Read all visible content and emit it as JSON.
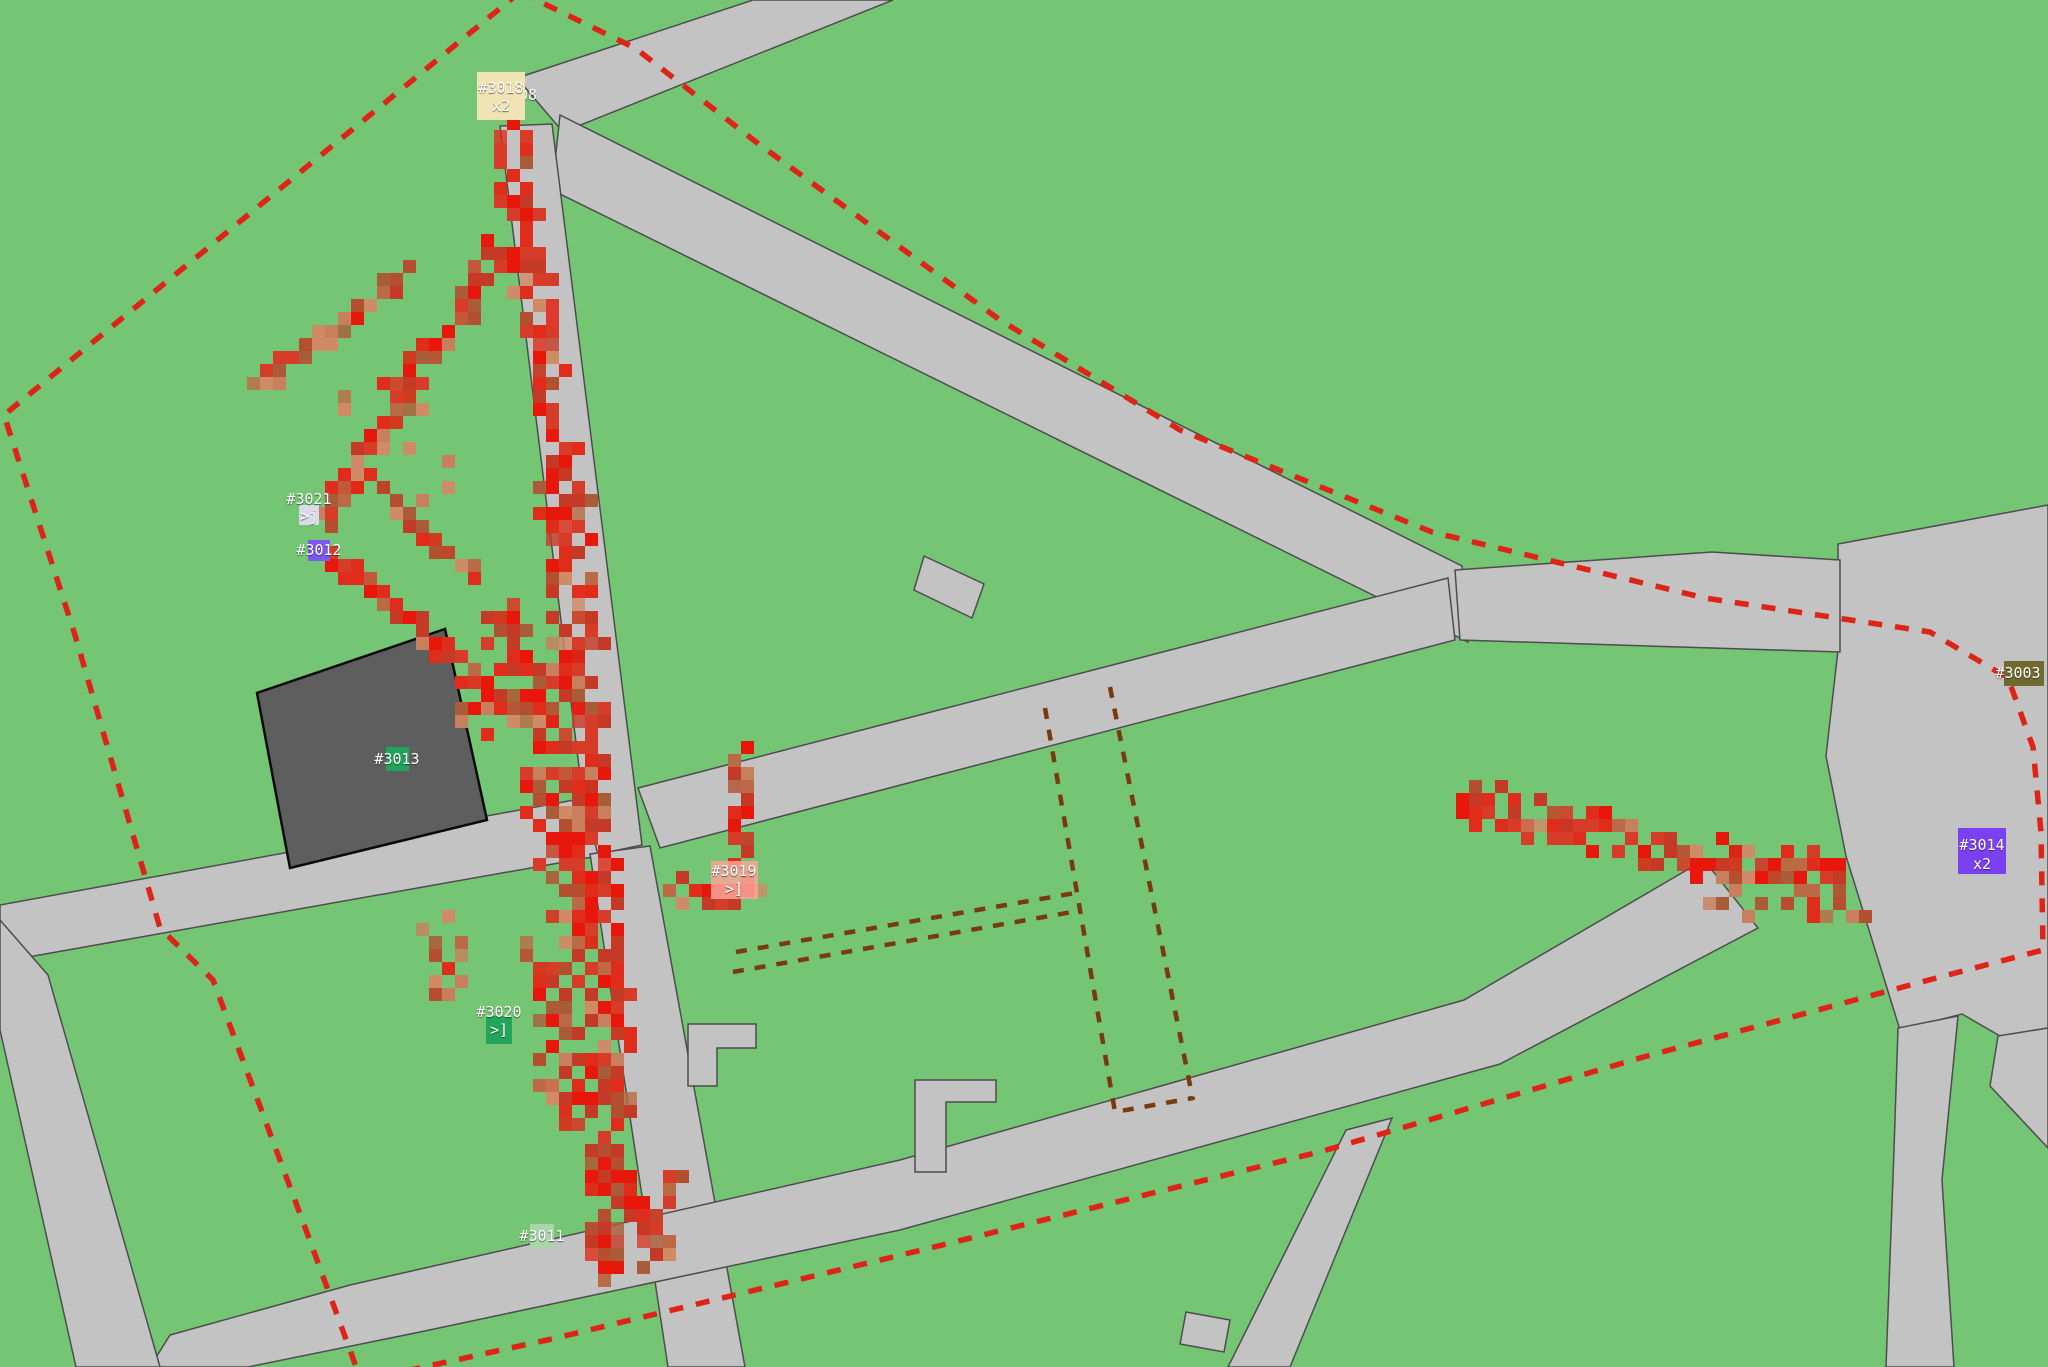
{
  "map": {
    "width": 2048,
    "height": 1367,
    "colors": {
      "grass": "#74c674",
      "road": "#c3c3c3",
      "road_edge": "#4d4d4d",
      "building": "#5e5e5e",
      "boundary_red": "#de2418",
      "zone_brown": "#7a3a10",
      "marker_text": "#ffffff"
    },
    "stray_label": {
      "text": "08",
      "x": 519,
      "y": 95
    },
    "markers": [
      {
        "id": "3018",
        "label": "#3018",
        "sublabel": "x2",
        "cx": 501,
        "ly": 88,
        "sy": 106,
        "box": {
          "x": 477,
          "y": 72,
          "w": 48,
          "h": 48
        },
        "color": "#f1e4b4"
      },
      {
        "id": "3021",
        "label": "#3021",
        "sublabel": ">j",
        "cx": 309,
        "ly": 499,
        "sy": 516,
        "box": {
          "x": 299,
          "y": 505,
          "w": 20,
          "h": 20
        },
        "color": "#d9dce8"
      },
      {
        "id": "3012",
        "label": "#3012",
        "sublabel": "",
        "cx": 319,
        "ly": 550,
        "sy": null,
        "box": {
          "x": 308,
          "y": 540,
          "w": 22,
          "h": 21
        },
        "color": "#7e57f0"
      },
      {
        "id": "3013",
        "label": "#3013",
        "sublabel": "",
        "cx": 397,
        "ly": 759,
        "sy": null,
        "box": {
          "x": 386,
          "y": 747,
          "w": 23,
          "h": 24
        },
        "color": "#21a35c"
      },
      {
        "id": "3019",
        "label": "#3019",
        "sublabel": ">]",
        "cx": 734,
        "ly": 871,
        "sy": 889,
        "box": {
          "x": 711,
          "y": 861,
          "w": 47,
          "h": 38
        },
        "color": "rgba(247,166,152,0.85)"
      },
      {
        "id": "3020",
        "label": "#3020",
        "sublabel": ">]",
        "cx": 499,
        "ly": 1012,
        "sy": 1030,
        "box": {
          "x": 486,
          "y": 1016,
          "w": 26,
          "h": 28
        },
        "color": "#23a55c"
      },
      {
        "id": "3011",
        "label": "#3011",
        "sublabel": "",
        "cx": 542,
        "ly": 1236,
        "sy": null,
        "box": {
          "x": 530,
          "y": 1224,
          "w": 24,
          "h": 24
        },
        "color": "#a9d5a9"
      },
      {
        "id": "3014",
        "label": "#3014",
        "sublabel": "x2",
        "cx": 1982,
        "ly": 845,
        "sy": 864,
        "box": {
          "x": 1958,
          "y": 828,
          "w": 48,
          "h": 46
        },
        "color": "#7b40f2"
      },
      {
        "id": "3003",
        "label": "#3003",
        "sublabel": "",
        "cx": 2018,
        "ly": 673,
        "sy": null,
        "box": {
          "x": 2004,
          "y": 661,
          "w": 40,
          "h": 25
        },
        "color": "#6f6a2e"
      }
    ],
    "boundary_paths": [
      "M 520 -8 L 4 415 L 75 635 L 160 928 L 213 980 L 306 1230 L 358 1372",
      "M 520 -8 L 635 48 L 760 145 L 1000 320 L 1180 430 L 1432 532 L 1705 598 L 1930 632 L 2008 678 L 2033 747 L 2041 832 L 2043 950 L 1940 977 L 1640 1058 L 1323 1151 L 926 1249 L 556 1338 L 392 1374"
    ],
    "zone_paths": [
      "M 1045 708 L 1115 1112 L 1193 1098",
      "M 1110 687 L 1193 1100",
      "M 736 952 L 1075 893",
      "M 733 972 L 1072 912"
    ],
    "trails": {
      "cell": 13,
      "palette_hot": [
        "#e7180b",
        "#e02c1b",
        "#d63c28",
        "#c53a26"
      ],
      "palette_warm": [
        "#bc6a45",
        "#c87f5e",
        "#aa5c38",
        "#cf8a66",
        "#b4502f"
      ],
      "segments": [
        {
          "x1": 499,
          "y1": 102,
          "x2": 556,
          "y2": 470,
          "w": 30,
          "tone": "hot",
          "d": 7
        },
        {
          "x1": 556,
          "y1": 470,
          "x2": 584,
          "y2": 792,
          "w": 42,
          "tone": "hot",
          "d": 6
        },
        {
          "x1": 505,
          "y1": 600,
          "x2": 565,
          "y2": 715,
          "w": 60,
          "tone": "mix",
          "d": 8
        },
        {
          "x1": 535,
          "y1": 760,
          "x2": 572,
          "y2": 935,
          "w": 48,
          "tone": "hot",
          "d": 6
        },
        {
          "x1": 545,
          "y1": 940,
          "x2": 558,
          "y2": 1120,
          "w": 45,
          "tone": "mix",
          "d": 7
        },
        {
          "x1": 584,
          "y1": 792,
          "x2": 606,
          "y2": 1095,
          "w": 38,
          "tone": "hot",
          "d": 6
        },
        {
          "x1": 606,
          "y1": 1095,
          "x2": 597,
          "y2": 1262,
          "w": 30,
          "tone": "hot",
          "d": 7
        },
        {
          "x1": 592,
          "y1": 1142,
          "x2": 657,
          "y2": 1248,
          "w": 20,
          "tone": "hot",
          "d": 8
        },
        {
          "x1": 497,
          "y1": 238,
          "x2": 316,
          "y2": 512,
          "w": 20,
          "tone": "hot",
          "d": 8
        },
        {
          "x1": 325,
          "y1": 556,
          "x2": 558,
          "y2": 737,
          "w": 20,
          "tone": "hot",
          "d": 8
        },
        {
          "x1": 250,
          "y1": 384,
          "x2": 397,
          "y2": 267,
          "w": 14,
          "tone": "warm",
          "d": 10
        },
        {
          "x1": 371,
          "y1": 482,
          "x2": 470,
          "y2": 568,
          "w": 14,
          "tone": "mix",
          "d": 10
        },
        {
          "x1": 737,
          "y1": 744,
          "x2": 737,
          "y2": 862,
          "w": 22,
          "tone": "hot",
          "d": 8
        },
        {
          "x1": 666,
          "y1": 884,
          "x2": 752,
          "y2": 884,
          "w": 22,
          "tone": "hot",
          "d": 8
        },
        {
          "x1": 1458,
          "y1": 798,
          "x2": 1840,
          "y2": 876,
          "w": 38,
          "tone": "hot",
          "d": 6
        }
      ],
      "scatter": [
        {
          "x": 1700,
          "y": 856,
          "w": 160,
          "h": 60,
          "n": 22,
          "tone": "warm"
        },
        {
          "x": 560,
          "y": 1160,
          "w": 110,
          "h": 110,
          "n": 18,
          "tone": "mix"
        },
        {
          "x": 455,
          "y": 620,
          "w": 110,
          "h": 130,
          "n": 20,
          "tone": "mix"
        },
        {
          "x": 420,
          "y": 900,
          "w": 70,
          "h": 120,
          "n": 12,
          "tone": "warm"
        },
        {
          "x": 330,
          "y": 380,
          "w": 120,
          "h": 140,
          "n": 10,
          "tone": "warm"
        }
      ]
    }
  }
}
